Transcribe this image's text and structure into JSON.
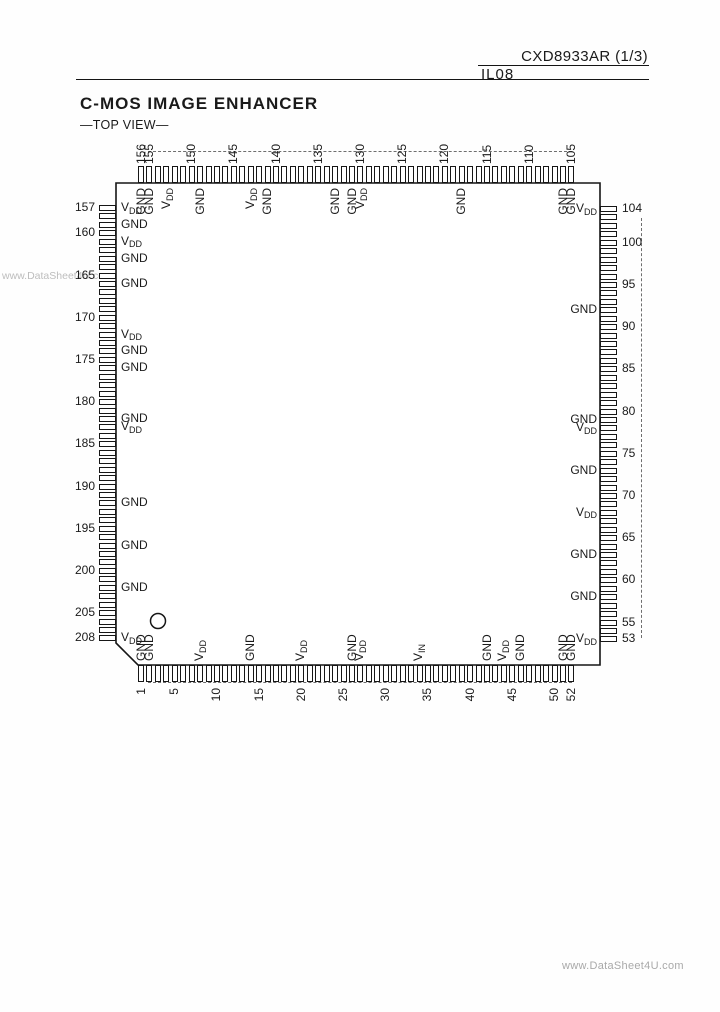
{
  "header": {
    "doc_code": "CXD8933AR (1/3)",
    "doc_num": "IL08"
  },
  "title": {
    "main": "C-MOS IMAGE ENHANCER",
    "view": "—TOP VIEW—"
  },
  "watermarks": {
    "left": "www.DataSheet4U.com",
    "bottom_right": "www.DataSheet4U.com"
  },
  "colors": {
    "ink": "#161616",
    "artifact_dark": "#6e6e6e",
    "artifact_light": "#c6c6c6",
    "watermark": "#bdbdbd"
  },
  "diagram": {
    "package_pins_total": 208,
    "pins_per_side": 52,
    "pitch": 8.44,
    "body": {
      "left": 116,
      "top": 183,
      "right": 600,
      "bottom": 665,
      "chamfer": 22
    },
    "pin": {
      "length": 17,
      "width": 6
    },
    "index_circle": {
      "cx": 158,
      "cy": 621,
      "r": 7.5
    },
    "sides": {
      "top": {
        "first_pin": 156,
        "step": -1,
        "origin": 141,
        "numbers": [
          156,
          155,
          150,
          145,
          140,
          135,
          130,
          125,
          120,
          115,
          110,
          105
        ],
        "labels": [
          {
            "pin": 156,
            "t": "GND"
          },
          {
            "pin": 155,
            "t": "GND"
          },
          {
            "pin": 153,
            "t": "VDD"
          },
          {
            "pin": 149,
            "t": "GND"
          },
          {
            "pin": 143,
            "t": "VDD"
          },
          {
            "pin": 141,
            "t": "GND"
          },
          {
            "pin": 133,
            "t": "GND"
          },
          {
            "pin": 131,
            "t": "GND"
          },
          {
            "pin": 130,
            "t": "VDD"
          },
          {
            "pin": 118,
            "t": "GND"
          },
          {
            "pin": 106,
            "t": "GND"
          },
          {
            "pin": 105,
            "t": "GND"
          }
        ]
      },
      "right": {
        "first_pin": 104,
        "step": -1,
        "origin": 209,
        "numbers": [
          104,
          100,
          95,
          90,
          85,
          80,
          75,
          70,
          65,
          60,
          55,
          53
        ],
        "labels": [
          {
            "pin": 104,
            "t": "VDD"
          },
          {
            "pin": 92,
            "t": "GND"
          },
          {
            "pin": 79,
            "t": "GND"
          },
          {
            "pin": 78,
            "t": "VDD"
          },
          {
            "pin": 73,
            "t": "GND"
          },
          {
            "pin": 68,
            "t": "VDD"
          },
          {
            "pin": 63,
            "t": "GND"
          },
          {
            "pin": 58,
            "t": "GND"
          },
          {
            "pin": 53,
            "t": "VDD"
          }
        ]
      },
      "left": {
        "first_pin": 157,
        "step": 1,
        "origin": 208,
        "numbers": [
          157,
          160,
          165,
          170,
          175,
          180,
          185,
          190,
          195,
          200,
          205,
          208
        ],
        "labels": [
          {
            "pin": 157,
            "t": "VDD"
          },
          {
            "pin": 159,
            "t": "GND"
          },
          {
            "pin": 161,
            "t": "VDD"
          },
          {
            "pin": 163,
            "t": "GND"
          },
          {
            "pin": 166,
            "t": "GND"
          },
          {
            "pin": 172,
            "t": "VDD"
          },
          {
            "pin": 174,
            "t": "GND"
          },
          {
            "pin": 176,
            "t": "GND"
          },
          {
            "pin": 182,
            "t": "GND"
          },
          {
            "pin": 183,
            "t": "VDD"
          },
          {
            "pin": 192,
            "t": "GND"
          },
          {
            "pin": 197,
            "t": "GND"
          },
          {
            "pin": 202,
            "t": "GND"
          },
          {
            "pin": 208,
            "t": "VDD"
          }
        ]
      },
      "bottom": {
        "first_pin": 1,
        "step": 1,
        "origin": 141,
        "numbers": [
          1,
          5,
          10,
          15,
          20,
          25,
          30,
          35,
          40,
          45,
          50,
          52
        ],
        "labels": [
          {
            "pin": 1,
            "t": "GND"
          },
          {
            "pin": 2,
            "t": "GND"
          },
          {
            "pin": 8,
            "t": "VDD"
          },
          {
            "pin": 14,
            "t": "GND"
          },
          {
            "pin": 20,
            "t": "VDD"
          },
          {
            "pin": 26,
            "t": "GND"
          },
          {
            "pin": 27,
            "t": "VDD"
          },
          {
            "pin": 34,
            "t": "VIN"
          },
          {
            "pin": 42,
            "t": "GND"
          },
          {
            "pin": 44,
            "t": "VDD"
          },
          {
            "pin": 46,
            "t": "GND"
          },
          {
            "pin": 51,
            "t": "GND"
          },
          {
            "pin": 52,
            "t": "GND"
          }
        ]
      }
    }
  }
}
